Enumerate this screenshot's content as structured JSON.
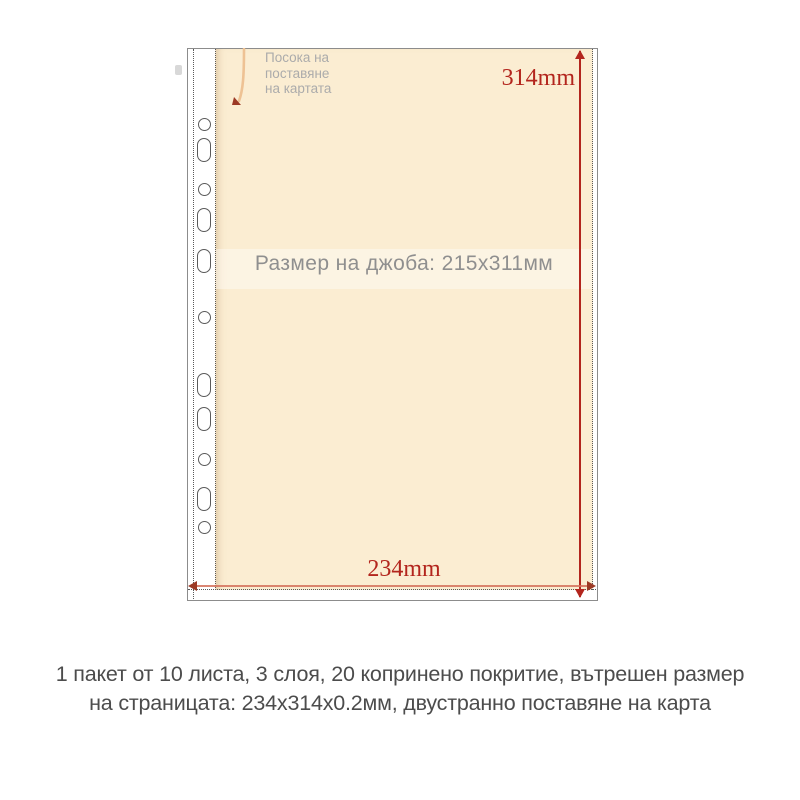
{
  "diagram": {
    "direction_label": {
      "line1": "Посока на",
      "line2": "поставяне",
      "line3": "на картата"
    },
    "pocket_label": "Размер на джоба: 215x311мм",
    "dim_height": "314mm",
    "dim_width": "234mm",
    "holes": [
      {
        "shape": "circle",
        "y": 75
      },
      {
        "shape": "oval",
        "y": 101
      },
      {
        "shape": "circle",
        "y": 140
      },
      {
        "shape": "oval",
        "y": 171
      },
      {
        "shape": "oval",
        "y": 212
      },
      {
        "shape": "circle",
        "y": 268
      },
      {
        "shape": "oval",
        "y": 336
      },
      {
        "shape": "oval",
        "y": 370
      },
      {
        "shape": "circle",
        "y": 410
      },
      {
        "shape": "oval",
        "y": 450
      },
      {
        "shape": "circle",
        "y": 478
      }
    ]
  },
  "caption": {
    "line1": "1 пакет от 10 листа, 3 слоя, 20 копринено покритие, вътрешен размер",
    "line2": "на страницата: 234x314x0.2мм, двустранно поставяне на карта"
  },
  "colors": {
    "pocket_fill": "#fbedd2",
    "dimension_red": "#b3251d",
    "dimension_red_light": "#d4715c",
    "text_gray_light": "#ababab",
    "text_gray_mid": "#8f8f8f",
    "text_dark": "#4c4c4c",
    "border_gray": "#8c8c8c",
    "dash_gray": "#5a5a5a",
    "insertion_arrow": "#eec294",
    "arrowhead_dark": "#9c3a25"
  }
}
